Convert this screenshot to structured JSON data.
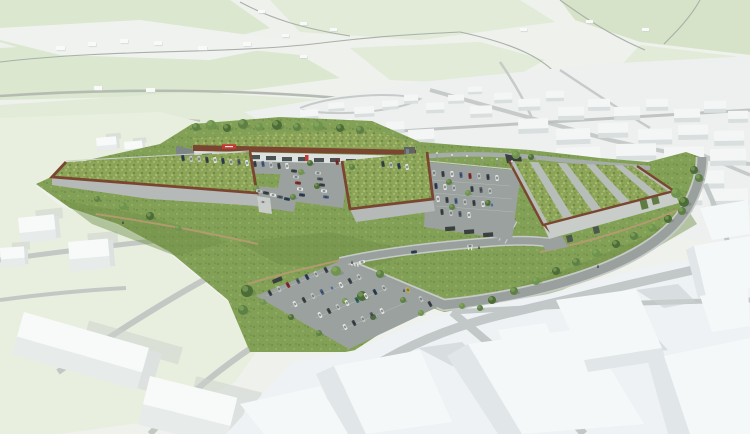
{
  "meta": {
    "type": "architectural-aerial-rendering",
    "subject": "aerial 3D visualization of a retail park development with green meadow roofs, rust-coloured parapets, parking lots, access loop road, landscaped embankments and surrounding white massing model of the existing town"
  },
  "palette": {
    "bg": "#eef1ec",
    "fieldA": "#dbe7cf",
    "fieldB": "#e1ebd7",
    "fieldC": "#d7e3c9",
    "white_patch": "#f0f2ef",
    "maproad": "#a9b0a8",
    "maproad2": "#b5bbb3",
    "town_ground": "#edf0ef",
    "town_road": "#c6cbc9",
    "town_band": "#b4bab9",
    "town_box": "#f4f6f6",
    "town_box_side": "#d9dfdf",
    "ctx_ground": "#e8efdf",
    "ctx_road": "#c3c8c4",
    "cube_top": "#f8fafa",
    "cube_front": "#e7ebea",
    "cube_side": "#dde2e1",
    "cube_shadow": "#cbd1ce",
    "grass": "#83a156",
    "grass_dark": "#6e8e48",
    "grass_light": "#95af63",
    "meadow": "#8ca558",
    "meadow_dot1": "#a9bb6e",
    "meadow_dot2": "#6d8a45",
    "meadow_dot3": "#c6d18a",
    "rust": "#7a4630",
    "roof_stripe": "#b7bdb8",
    "green_wall": "#5f7d43",
    "wall_gray": "#b5bab8",
    "wall_light": "#c8cdca",
    "retain": "#7e8585",
    "asphalt": "#9ba19e",
    "road": "#9aa09d",
    "sidewalk": "#c6cbc8",
    "lot_line": "#c9cec9",
    "path": "#b59b72",
    "top_road": "#a6aca9",
    "storefront": "#dde1df",
    "glazing": "#3e4648",
    "sign_red": "#c23a32",
    "dark_struct": "#5f6564",
    "fence": "#ccd1cd",
    "facade_stripe": "#a9afac",
    "tree": "#5d8145",
    "tree2": "#6f944e",
    "tree_dark": "#4c6c38",
    "pole": "#8a9090",
    "pole_top": "#f2f4f2",
    "shelter": "#3a403e",
    "person": "#2e343a",
    "fg_ground": "#eef2f4",
    "fg_prism": "#f5f8f9",
    "fg_prism_side": "#e1e7e9",
    "fg_road": "#c2c8c8",
    "fg_shadow": "#c9d0d0",
    "car_colors": [
      "#e9ebea",
      "#c6cac9",
      "#9aa09f",
      "#3f454a",
      "#31405a",
      "#4f6488",
      "#8f2e29",
      "#5a6268",
      "#c8b13d",
      "#2f6f68",
      "#8fa3b5"
    ]
  },
  "scene": {
    "bg_boxes": [
      [
        56,
        46,
        9,
        4
      ],
      [
        88,
        42,
        8,
        4
      ],
      [
        120,
        39,
        8,
        4
      ],
      [
        154,
        41,
        8,
        4
      ],
      [
        198,
        46,
        9,
        4
      ],
      [
        243,
        42,
        8,
        4
      ],
      [
        282,
        34,
        7,
        3
      ],
      [
        330,
        28,
        7,
        3
      ],
      [
        300,
        55,
        7,
        3
      ],
      [
        146,
        88,
        9,
        4
      ],
      [
        94,
        86,
        8,
        4
      ],
      [
        372,
        94,
        8,
        4
      ],
      [
        398,
        88,
        8,
        4
      ],
      [
        520,
        28,
        7,
        3
      ],
      [
        586,
        20,
        7,
        3
      ],
      [
        642,
        28,
        7,
        3
      ],
      [
        258,
        10,
        7,
        3
      ],
      [
        300,
        22,
        7,
        3
      ]
    ],
    "town_boxes": [
      [
        300,
        110,
        18,
        7,
        -4
      ],
      [
        328,
        103,
        16,
        6,
        -4
      ],
      [
        354,
        107,
        20,
        7,
        -3
      ],
      [
        382,
        101,
        16,
        6,
        -3
      ],
      [
        404,
        95,
        14,
        6,
        -2
      ],
      [
        426,
        103,
        18,
        7,
        -2
      ],
      [
        448,
        95,
        16,
        6,
        -2
      ],
      [
        468,
        87,
        14,
        5,
        -2
      ],
      [
        470,
        106,
        22,
        8,
        -2
      ],
      [
        494,
        93,
        18,
        7,
        -2
      ],
      [
        518,
        99,
        22,
        8,
        -2
      ],
      [
        546,
        91,
        18,
        7,
        -1
      ],
      [
        558,
        107,
        26,
        9,
        -1
      ],
      [
        588,
        99,
        22,
        8,
        -1
      ],
      [
        614,
        107,
        26,
        9,
        -1
      ],
      [
        646,
        99,
        22,
        8,
        -1
      ],
      [
        674,
        109,
        26,
        9,
        -1
      ],
      [
        704,
        101,
        22,
        8,
        -1
      ],
      [
        728,
        111,
        20,
        8,
        -1
      ],
      [
        518,
        119,
        30,
        10,
        -2
      ],
      [
        556,
        129,
        34,
        11,
        -2
      ],
      [
        598,
        123,
        30,
        10,
        -1
      ],
      [
        638,
        129,
        34,
        11,
        -1
      ],
      [
        678,
        125,
        30,
        10,
        -1
      ],
      [
        714,
        131,
        30,
        10,
        -1
      ],
      [
        300,
        126,
        26,
        10,
        -4
      ],
      [
        332,
        120,
        20,
        9,
        -4
      ],
      [
        358,
        128,
        24,
        9,
        -3
      ],
      [
        386,
        122,
        18,
        8,
        -3
      ],
      [
        408,
        130,
        26,
        10,
        -3
      ],
      [
        616,
        144,
        40,
        12,
        -1
      ],
      [
        664,
        147,
        40,
        12,
        -1
      ],
      [
        710,
        149,
        36,
        12,
        -1
      ],
      [
        556,
        148,
        44,
        12,
        -2
      ],
      [
        570,
        166,
        46,
        13,
        -1
      ],
      [
        630,
        168,
        40,
        12,
        -1
      ],
      [
        684,
        171,
        40,
        13,
        -1
      ],
      [
        598,
        184,
        50,
        13,
        -1
      ],
      [
        658,
        188,
        44,
        13,
        -1
      ],
      [
        710,
        189,
        38,
        12,
        -1
      ]
    ],
    "ctx_cubes": [
      [
        18,
        218,
        36,
        26,
        -6
      ],
      [
        68,
        242,
        40,
        30,
        -5
      ],
      [
        160,
        224,
        48,
        30,
        -5
      ],
      [
        0,
        248,
        24,
        20,
        -4
      ],
      [
        24,
        312,
        130,
        44,
        16
      ],
      [
        150,
        376,
        90,
        50,
        14
      ],
      [
        96,
        138,
        20,
        14,
        -5
      ],
      [
        124,
        142,
        18,
        13,
        -5
      ]
    ],
    "trees": [
      [
        196,
        127,
        4
      ],
      [
        211,
        125,
        5
      ],
      [
        227,
        128,
        4
      ],
      [
        243,
        124,
        5
      ],
      [
        259,
        127,
        4
      ],
      [
        277,
        125,
        5
      ],
      [
        297,
        127,
        4
      ],
      [
        318,
        126,
        5
      ],
      [
        340,
        128,
        4
      ],
      [
        360,
        130,
        4
      ],
      [
        516,
        155,
        4
      ],
      [
        531,
        157,
        3
      ],
      [
        449,
        182,
        3
      ],
      [
        468,
        193,
        3
      ],
      [
        488,
        203,
        3
      ],
      [
        452,
        207,
        3
      ],
      [
        301,
        172,
        3
      ],
      [
        317,
        186,
        3
      ],
      [
        293,
        197,
        3
      ],
      [
        256,
        188,
        3
      ],
      [
        310,
        163,
        3
      ],
      [
        352,
        167,
        3
      ],
      [
        123,
        206,
        4
      ],
      [
        150,
        216,
        4
      ],
      [
        97,
        199,
        3
      ],
      [
        178,
        228,
        3
      ],
      [
        247,
        291,
        6
      ],
      [
        243,
        310,
        5
      ],
      [
        336,
        271,
        5
      ],
      [
        362,
        296,
        5
      ],
      [
        380,
        274,
        4
      ],
      [
        263,
        302,
        3
      ],
      [
        291,
        317,
        3
      ],
      [
        319,
        333,
        3
      ],
      [
        345,
        301,
        3
      ],
      [
        373,
        317,
        3
      ],
      [
        403,
        300,
        3
      ],
      [
        421,
        313,
        3
      ],
      [
        492,
        300,
        4
      ],
      [
        514,
        291,
        4
      ],
      [
        536,
        281,
        4
      ],
      [
        556,
        271,
        4
      ],
      [
        576,
        262,
        4
      ],
      [
        596,
        253,
        4
      ],
      [
        616,
        244,
        4
      ],
      [
        634,
        236,
        4
      ],
      [
        652,
        228,
        4
      ],
      [
        668,
        219,
        4
      ],
      [
        682,
        211,
        4
      ],
      [
        676,
        193,
        5
      ],
      [
        684,
        202,
        5
      ],
      [
        480,
        308,
        3
      ],
      [
        462,
        306,
        3
      ],
      [
        694,
        170,
        4
      ],
      [
        699,
        178,
        4
      ]
    ],
    "cars": [
      [
        183,
        158,
        80,
        4
      ],
      [
        191,
        159,
        80,
        1
      ],
      [
        199,
        159,
        80,
        1
      ],
      [
        207,
        160,
        80,
        3
      ],
      [
        215,
        160,
        80,
        0
      ],
      [
        223,
        161,
        80,
        4
      ],
      [
        231,
        162,
        80,
        1
      ],
      [
        239,
        162,
        80,
        7
      ],
      [
        247,
        163,
        80,
        0
      ],
      [
        255,
        164,
        80,
        3
      ],
      [
        263,
        164,
        80,
        5
      ],
      [
        271,
        165,
        80,
        1
      ],
      [
        279,
        166,
        80,
        3
      ],
      [
        287,
        166,
        80,
        0
      ],
      [
        337,
        162,
        75,
        6
      ],
      [
        383,
        164,
        78,
        3
      ],
      [
        391,
        165,
        78,
        1
      ],
      [
        399,
        166,
        78,
        4
      ],
      [
        407,
        167,
        78,
        0
      ],
      [
        259,
        191,
        10,
        1
      ],
      [
        266,
        193,
        10,
        3
      ],
      [
        273,
        195,
        10,
        0
      ],
      [
        280,
        197,
        10,
        7
      ],
      [
        287,
        199,
        10,
        4
      ],
      [
        263,
        202,
        12,
        1
      ],
      [
        294,
        171,
        8,
        3
      ],
      [
        296,
        177,
        8,
        1
      ],
      [
        298,
        183,
        8,
        6
      ],
      [
        300,
        189,
        8,
        0
      ],
      [
        302,
        195,
        8,
        4
      ],
      [
        318,
        173,
        8,
        1
      ],
      [
        320,
        179,
        8,
        7
      ],
      [
        322,
        185,
        8,
        3
      ],
      [
        324,
        191,
        8,
        0
      ],
      [
        326,
        197,
        8,
        5
      ],
      [
        434,
        173,
        84,
        1
      ],
      [
        443,
        174,
        84,
        3
      ],
      [
        452,
        174,
        84,
        0
      ],
      [
        461,
        175,
        84,
        5
      ],
      [
        470,
        176,
        84,
        6
      ],
      [
        479,
        176,
        84,
        1
      ],
      [
        488,
        177,
        84,
        3
      ],
      [
        497,
        178,
        84,
        0
      ],
      [
        436,
        186,
        84,
        4
      ],
      [
        445,
        187,
        84,
        0
      ],
      [
        454,
        188,
        84,
        1
      ],
      [
        472,
        189,
        84,
        3
      ],
      [
        481,
        190,
        84,
        7
      ],
      [
        490,
        191,
        84,
        1
      ],
      [
        438,
        199,
        84,
        0
      ],
      [
        447,
        200,
        84,
        3
      ],
      [
        456,
        201,
        84,
        5
      ],
      [
        465,
        202,
        84,
        1
      ],
      [
        474,
        203,
        84,
        3
      ],
      [
        483,
        204,
        84,
        0
      ],
      [
        492,
        205,
        84,
        10
      ],
      [
        442,
        212,
        84,
        3
      ],
      [
        451,
        213,
        84,
        1
      ],
      [
        460,
        214,
        84,
        7
      ],
      [
        469,
        215,
        84,
        0
      ],
      [
        270,
        293,
        62,
        3
      ],
      [
        279,
        289,
        62,
        1
      ],
      [
        288,
        285,
        62,
        6
      ],
      [
        298,
        281,
        62,
        7
      ],
      [
        307,
        277,
        62,
        4
      ],
      [
        316,
        274,
        62,
        1
      ],
      [
        326,
        270,
        62,
        3
      ],
      [
        295,
        304,
        62,
        0
      ],
      [
        304,
        300,
        62,
        3
      ],
      [
        313,
        296,
        62,
        1
      ],
      [
        322,
        292,
        62,
        5
      ],
      [
        332,
        288,
        62,
        10
      ],
      [
        341,
        285,
        62,
        0
      ],
      [
        350,
        281,
        62,
        3
      ],
      [
        359,
        277,
        62,
        1
      ],
      [
        320,
        315,
        62,
        0
      ],
      [
        329,
        311,
        62,
        3
      ],
      [
        338,
        307,
        62,
        1
      ],
      [
        347,
        303,
        62,
        0
      ],
      [
        357,
        300,
        62,
        9
      ],
      [
        366,
        296,
        62,
        0
      ],
      [
        375,
        292,
        62,
        4
      ],
      [
        384,
        288,
        62,
        1
      ],
      [
        345,
        327,
        62,
        0
      ],
      [
        354,
        323,
        62,
        3
      ],
      [
        363,
        319,
        62,
        1
      ],
      [
        372,
        315,
        62,
        7
      ],
      [
        382,
        311,
        62,
        0
      ],
      [
        408,
        290,
        62,
        8
      ],
      [
        421,
        299,
        60,
        1
      ],
      [
        430,
        304,
        60,
        3
      ],
      [
        362,
        262,
        -12,
        0
      ],
      [
        414,
        252,
        -8,
        4
      ],
      [
        470,
        246,
        -6,
        1
      ]
    ],
    "poles": [
      [
        437,
        160
      ],
      [
        452,
        162
      ],
      [
        467,
        163
      ],
      [
        482,
        165
      ],
      [
        497,
        166
      ],
      [
        512,
        168
      ]
    ],
    "shelters": [
      [
        445,
        227,
        -4
      ],
      [
        464,
        230,
        -4
      ],
      [
        483,
        233,
        -4
      ],
      [
        272,
        280,
        -22
      ]
    ],
    "people": [
      [
        352,
        264
      ],
      [
        404,
        292
      ],
      [
        479,
        249
      ],
      [
        123,
        224
      ],
      [
        598,
        268
      ]
    ],
    "windows": [
      [
        202,
        153
      ],
      [
        218,
        154
      ],
      [
        234,
        155
      ],
      [
        250,
        155
      ],
      [
        266,
        156
      ],
      [
        282,
        157
      ],
      [
        298,
        157
      ],
      [
        314,
        158
      ],
      [
        330,
        158
      ],
      [
        346,
        159
      ],
      [
        362,
        160
      ],
      [
        378,
        160
      ],
      [
        394,
        161
      ]
    ],
    "markings": [
      [
        351,
        263,
        -12
      ],
      [
        354,
        263.5,
        -12
      ],
      [
        357,
        264,
        -12
      ],
      [
        468,
        247,
        -6
      ],
      [
        471,
        247.5,
        -6
      ]
    ]
  }
}
